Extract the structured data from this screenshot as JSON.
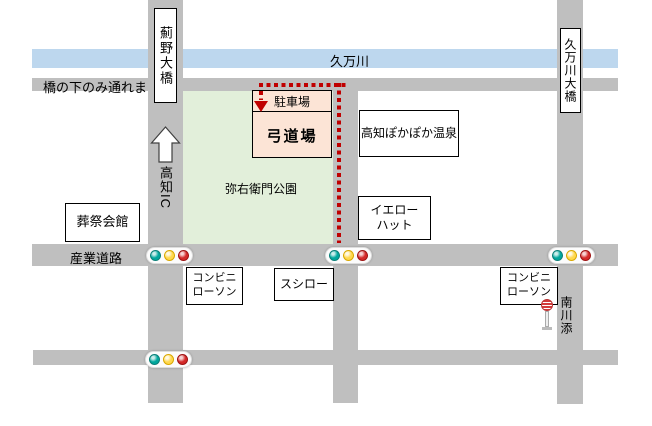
{
  "colors": {
    "road": "#BFBFBF",
    "river": "#BDD7EE",
    "park": "#E2EFDA",
    "destination_fill": "#FCE4D6",
    "route": "#C00000",
    "light_teal": "#00A79D",
    "light_yellow": "#FFD84D",
    "light_red": "#D42A2A"
  },
  "river": {
    "label": "久万川"
  },
  "roads": {
    "bridge_note": "橋の下のみ通れます",
    "sangyo_label": "産業道路",
    "azono_bridge_label": "薊野大橋",
    "kumangawa_bridge_label": "久万川大橋",
    "kochi_ic_label": "高知IC",
    "bus_stop_label": "南川添"
  },
  "park": {
    "label": "弥右衛門公園"
  },
  "destination": {
    "parking_label": "駐車場",
    "dojo_label": "弓道場"
  },
  "buildings": {
    "onsen": "高知ぽかぽか温泉",
    "yellow_hat_line1": "イエロー",
    "yellow_hat_line2": "ハット",
    "funeral_hall": "葬祭会館",
    "lawson_left_line1": "コンビニ",
    "lawson_left_line2": "ローソン",
    "sushiro": "スシロー",
    "lawson_right_line1": "コンビニ",
    "lawson_right_line2": "ローソン"
  }
}
